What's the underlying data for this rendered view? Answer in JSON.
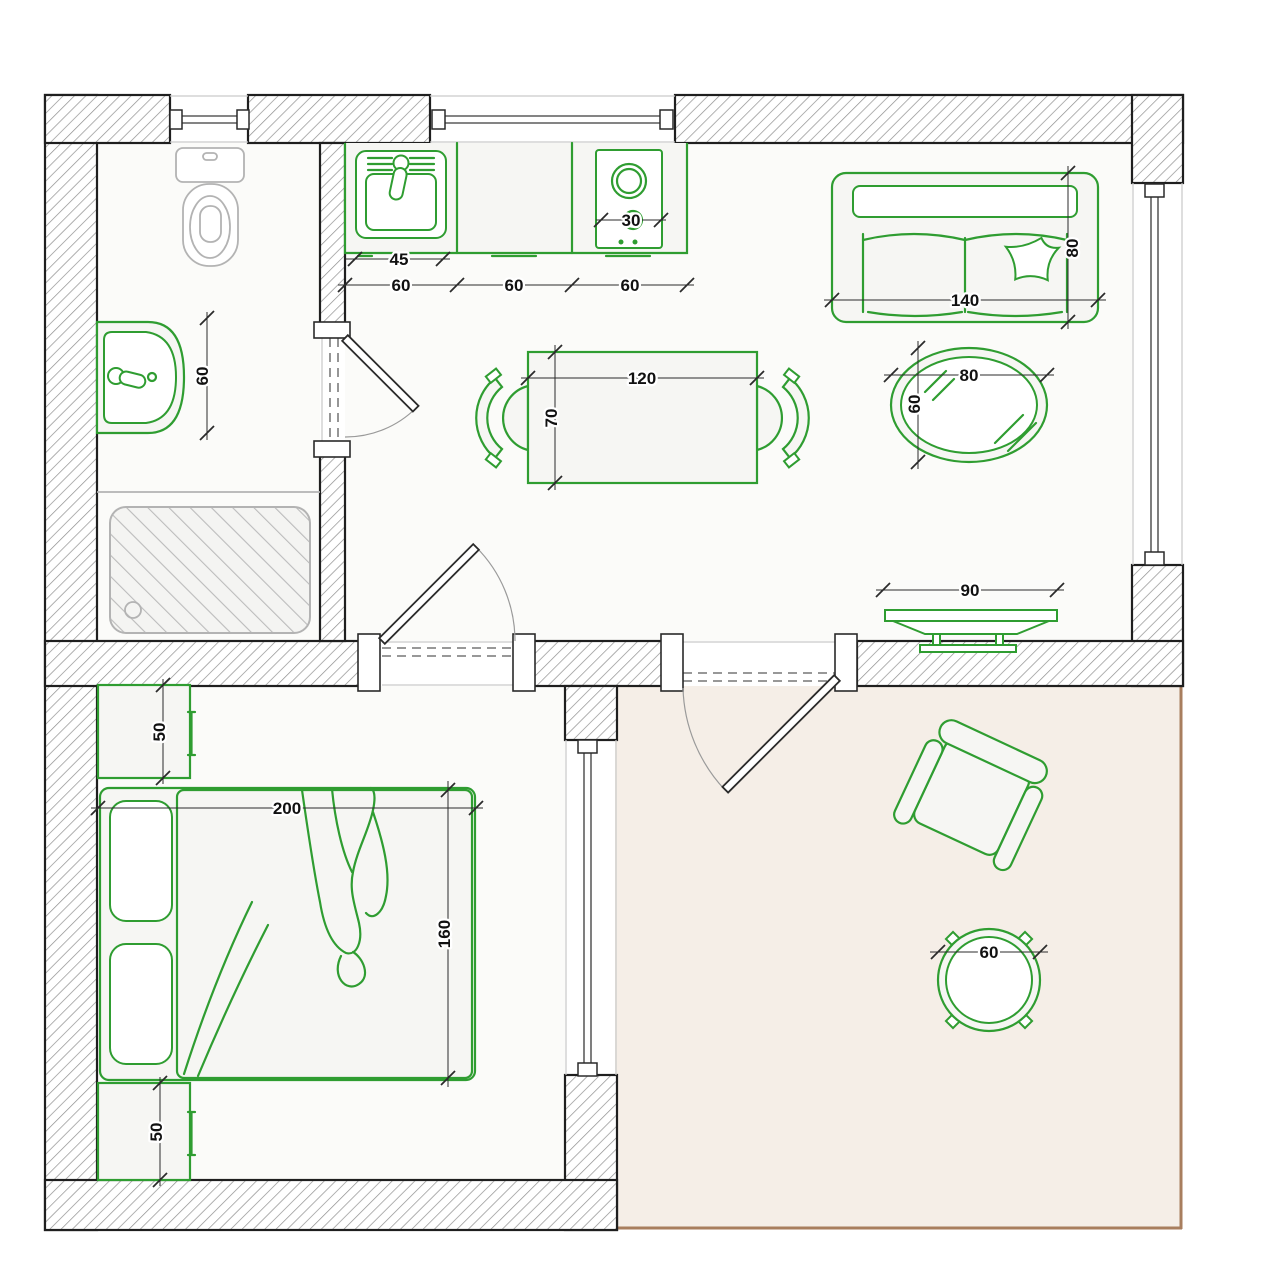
{
  "drawing": {
    "kind": "apartment floor plan",
    "colors": {
      "furniture_accent": "#2f9d31",
      "wall_hatch": "#8f8f8f",
      "sanitary_gray": "#b3b3b3",
      "terrace_floor": "#f5eee7",
      "terrace_border": "#a87e5e",
      "dimension_text": "#111111"
    }
  },
  "dims": {
    "bathroom": {
      "washbasin_width": "60"
    },
    "kitchen": {
      "sink_width": "45",
      "units": [
        "60",
        "60",
        "60"
      ],
      "hob_width": "30"
    },
    "dining": {
      "table_length": "120",
      "table_width": "70"
    },
    "living": {
      "sofa_width": "140",
      "sofa_depth": "80",
      "coffee_table_length": "80",
      "coffee_table_width": "60",
      "tv_width": "90"
    },
    "bedroom": {
      "top_wardrobe_depth": "50",
      "bed_width": "200",
      "bed_depth": "160",
      "bottom_wardrobe_depth": "50"
    },
    "terrace": {
      "round_table_diameter": "60"
    }
  }
}
